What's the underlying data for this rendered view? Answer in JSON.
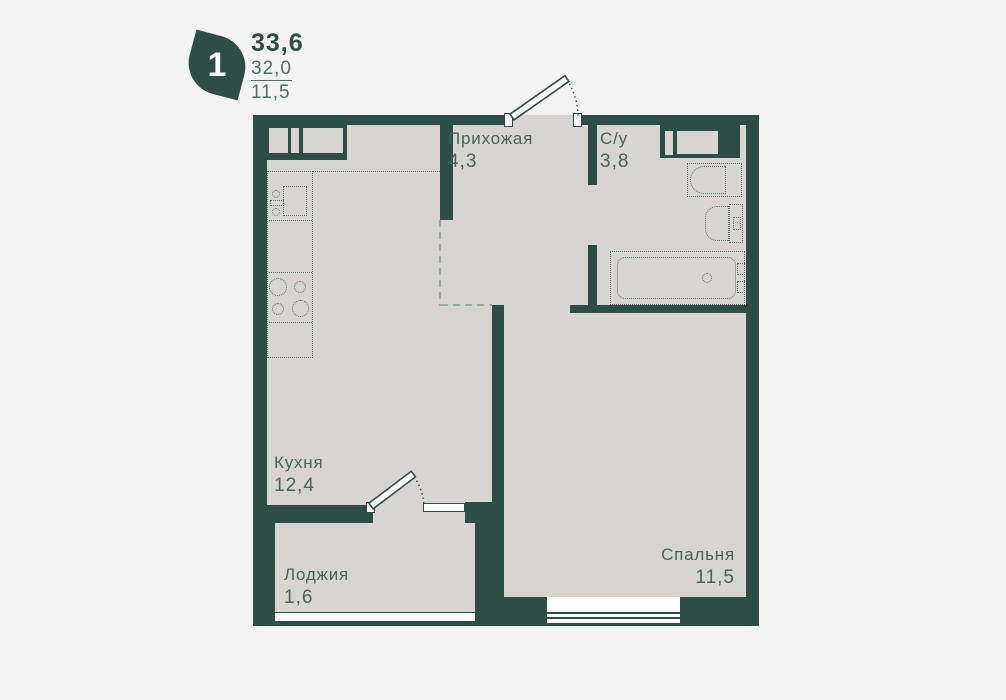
{
  "legend": {
    "rooms_count": "1",
    "area_total": "33,6",
    "area_living": "32,0",
    "area_kitchen": "11,5"
  },
  "rooms": {
    "hallway": {
      "name": "Прихожая",
      "area": "4,3"
    },
    "bathroom": {
      "name": "С/у",
      "area": "3,8"
    },
    "kitchen": {
      "name": "Кухня",
      "area": "12,4"
    },
    "loggia": {
      "name": "Лоджия",
      "area": "1,6"
    },
    "bedroom": {
      "name": "Спальня",
      "area": "11,5"
    }
  },
  "colors": {
    "wall": "#2d4e46",
    "floor": "#d7d4d1",
    "background": "#f4f3f4",
    "fixture": "#517065",
    "zone_dash": "#97a9a1",
    "label": "#47655c",
    "legend_primary": "#2d4e46",
    "legend_secondary": "#537068"
  }
}
